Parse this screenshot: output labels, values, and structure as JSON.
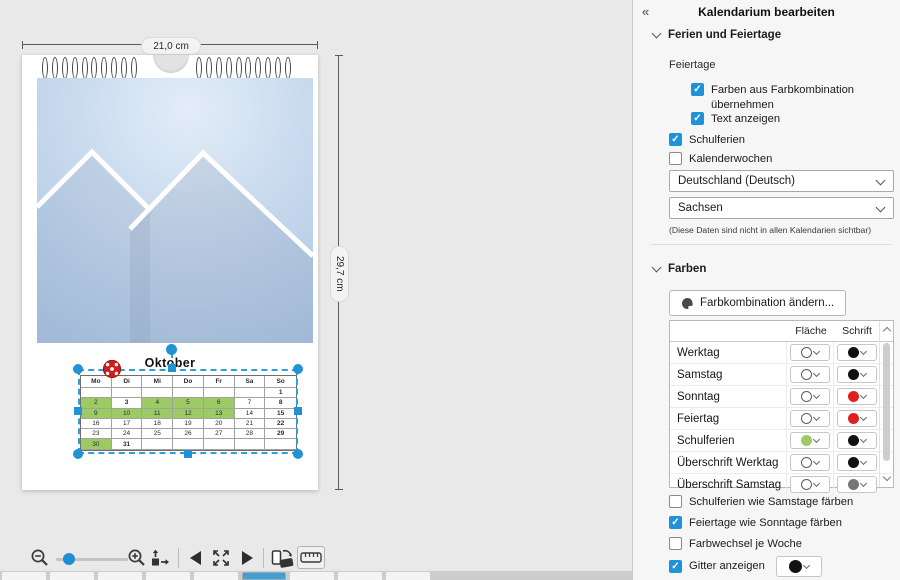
{
  "colors": {
    "accent_blue": "#2f9fd8",
    "checkbox_blue": "#2093d8",
    "holiday_red": "#d32420",
    "school_green": "#9dcb63",
    "saturday_gray": "#8c8c8c"
  },
  "panel": {
    "collapse_icon": "«",
    "title": "Kalendarium bearbeiten",
    "ferien": {
      "title": "Ferien und Feiertage",
      "feiertage_label": "Feiertage",
      "cb_farben": {
        "label": "Farben aus Farbkombination übernehmen",
        "checked": true
      },
      "cb_text": {
        "label": "Text anzeigen",
        "checked": true
      },
      "cb_schulferien": {
        "label": "Schulferien",
        "checked": true
      },
      "cb_kalenderwochen": {
        "label": "Kalenderwochen",
        "checked": false
      },
      "country": "Deutschland (Deutsch)",
      "region": "Sachsen",
      "note": "(Diese Daten sind nicht in allen Kalendarien sichtbar)"
    },
    "farben": {
      "title": "Farben",
      "change_button": "Farbkombination ändern...",
      "col_flaeche": "Fläche",
      "col_schrift": "Schrift",
      "rows": [
        {
          "label": "Werktag",
          "flaeche": "#ffffff",
          "schrift": "#111111"
        },
        {
          "label": "Samstag",
          "flaeche": "#ffffff",
          "schrift": "#111111"
        },
        {
          "label": "Sonntag",
          "flaeche": "#ffffff",
          "schrift": "#e02020"
        },
        {
          "label": "Feiertag",
          "flaeche": "#ffffff",
          "schrift": "#e02020"
        },
        {
          "label": "Schulferien",
          "flaeche": "#9dcb63",
          "schrift": "#111111"
        },
        {
          "label": "Überschrift Werktag",
          "flaeche": "#ffffff",
          "schrift": "#111111"
        },
        {
          "label": "Überschrift Samstag",
          "flaeche": "#ffffff",
          "schrift": "#767676"
        }
      ],
      "cb_sf_sa": {
        "label": "Schulferien wie Samstage färben",
        "checked": false
      },
      "cb_ft_so": {
        "label": "Feiertage wie Sonntage färben",
        "checked": true
      },
      "cb_wechsel": {
        "label": "Farbwechsel je Woche",
        "checked": false
      },
      "cb_gitter": {
        "label": "Gitter anzeigen",
        "checked": true,
        "color": "#111111"
      }
    }
  },
  "canvas": {
    "width_label": "21,0 cm",
    "height_label": "29,7 cm",
    "month": "Oktober",
    "cal": {
      "headers": [
        "Mo",
        "Di",
        "Mi",
        "Do",
        "Fr",
        "Sa",
        "So"
      ],
      "weeks": [
        [
          [
            "",
            ""
          ],
          [
            "",
            ""
          ],
          [
            "",
            ""
          ],
          [
            "",
            ""
          ],
          [
            "",
            ""
          ],
          [
            "",
            ""
          ],
          [
            "1",
            "sun"
          ]
        ],
        [
          [
            "2",
            "sf"
          ],
          [
            "3",
            "hol"
          ],
          [
            "4",
            "sf"
          ],
          [
            "5",
            "sf"
          ],
          [
            "6",
            "sf"
          ],
          [
            "7",
            "wd"
          ],
          [
            "8",
            "sun"
          ]
        ],
        [
          [
            "9",
            "sf"
          ],
          [
            "10",
            "sf"
          ],
          [
            "11",
            "sf"
          ],
          [
            "12",
            "sf"
          ],
          [
            "13",
            "sf"
          ],
          [
            "14",
            "wd"
          ],
          [
            "15",
            "sun"
          ]
        ],
        [
          [
            "16",
            "wd"
          ],
          [
            "17",
            "wd"
          ],
          [
            "18",
            "wd"
          ],
          [
            "19",
            "wd"
          ],
          [
            "20",
            "wd"
          ],
          [
            "21",
            "wd"
          ],
          [
            "22",
            "sun"
          ]
        ],
        [
          [
            "23",
            "wd"
          ],
          [
            "24",
            "wd"
          ],
          [
            "25",
            "wd"
          ],
          [
            "26",
            "wd"
          ],
          [
            "27",
            "wd"
          ],
          [
            "28",
            "wd"
          ],
          [
            "29",
            "sun"
          ]
        ],
        [
          [
            "30",
            "sf"
          ],
          [
            "31",
            "hol"
          ],
          [
            "",
            ""
          ],
          [
            "",
            ""
          ],
          [
            "",
            ""
          ],
          [
            "",
            ""
          ],
          [
            "",
            ""
          ]
        ]
      ]
    }
  },
  "toolbar": {
    "icons": [
      "zoom-out",
      "zoom-slider",
      "zoom-in",
      "export-pages",
      "previous-page",
      "fit-to-window",
      "next-page",
      "toggle-orientation",
      "show-ruler"
    ]
  },
  "strip": {
    "pages": 9,
    "selected": 5
  }
}
